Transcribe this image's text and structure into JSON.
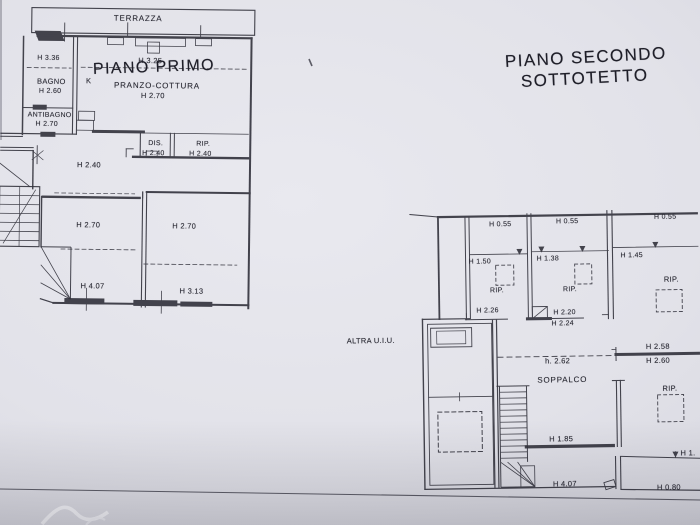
{
  "colors": {
    "paper": "#e2e2e9",
    "ink": "#31313b"
  },
  "primo": {
    "title": "PIANO PRIMO",
    "labels": {
      "terrazza": "TERRAZZA",
      "h336": "H 3.36",
      "bagno": "BAGNO",
      "bagno_h": "H 2.60",
      "k": "K",
      "h325": "H 3.25",
      "pranzo": "PRANZO-COTTURA",
      "pranzo_h": "H 2.70",
      "antibagno": "ANTIBAGNO",
      "antibagno_h": "H 2.70",
      "dis": "DIS.",
      "dis_h": "H 2.40",
      "rip": "RIP.",
      "rip_h": "H 2.40",
      "corridoio_h": "H 2.40",
      "camera_sx_h": "H 2.70",
      "camera_dx_h": "H 2.70",
      "larghezza_sx": "H 4.07",
      "larghezza_dx": "H 3.13"
    }
  },
  "secondo": {
    "title_line1": "PIANO SECONDO",
    "title_line2": "SOTTOTETTO",
    "altra_uiu": "ALTRA U.I.U.",
    "labels": {
      "c1_top": "H 0.55",
      "c2_top": "H 0.55",
      "c3_top": "H 0.55",
      "c1_mid": "H 1.50",
      "c2_mid": "H 1.38",
      "c3_mid": "H 1.45",
      "c1_rip": "RIP.",
      "c2_rip": "RIP.",
      "c3_rip": "RIP.",
      "c1_low": "H 2.26",
      "c2_low": "H 2.20",
      "c2_low2": "H 2.24",
      "h258": "H 2.58",
      "h260": "H 2.60",
      "h262": "h. 2.62",
      "soppalco": "SOPPALCO",
      "rip_dx": "RIP.",
      "h185": "H 1.85",
      "h407": "H 4.07",
      "h1_cut": "H 1.",
      "h080": "H 0.80"
    }
  }
}
